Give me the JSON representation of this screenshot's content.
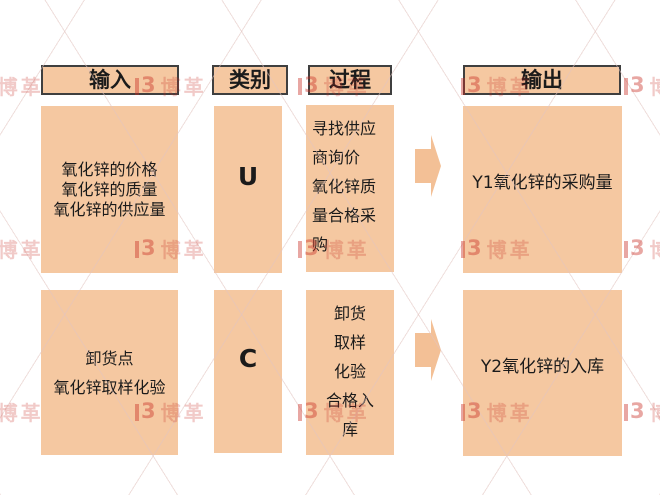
{
  "headers": {
    "input": "输入",
    "category": "类别",
    "process": "过程",
    "output": "输出"
  },
  "rows": [
    {
      "inputs": [
        "氧化锌的价格",
        "氧化锌的质量",
        "氧化锌的供应量"
      ],
      "category": "U",
      "process_lines": [
        "寻找供应",
        "商询价",
        "氧化锌质",
        "量合格采",
        "购"
      ],
      "output": "Y1氧化锌的采购量"
    },
    {
      "inputs": [
        "卸货点",
        "氧化锌取样化验"
      ],
      "category": "C",
      "process_lines": [
        "卸货",
        "取样",
        "化验",
        "合格入",
        "库"
      ],
      "output": "Y2氧化锌的入库"
    }
  ],
  "watermark": {
    "logo_text": "3",
    "brand_text": "博革"
  },
  "colors": {
    "box_fill": "#f5c8a1",
    "arrow_fill": "#f3c096",
    "header_border": "#3f3f3f",
    "text": "#1b1b1b",
    "watermark_red": "#c83c30"
  }
}
